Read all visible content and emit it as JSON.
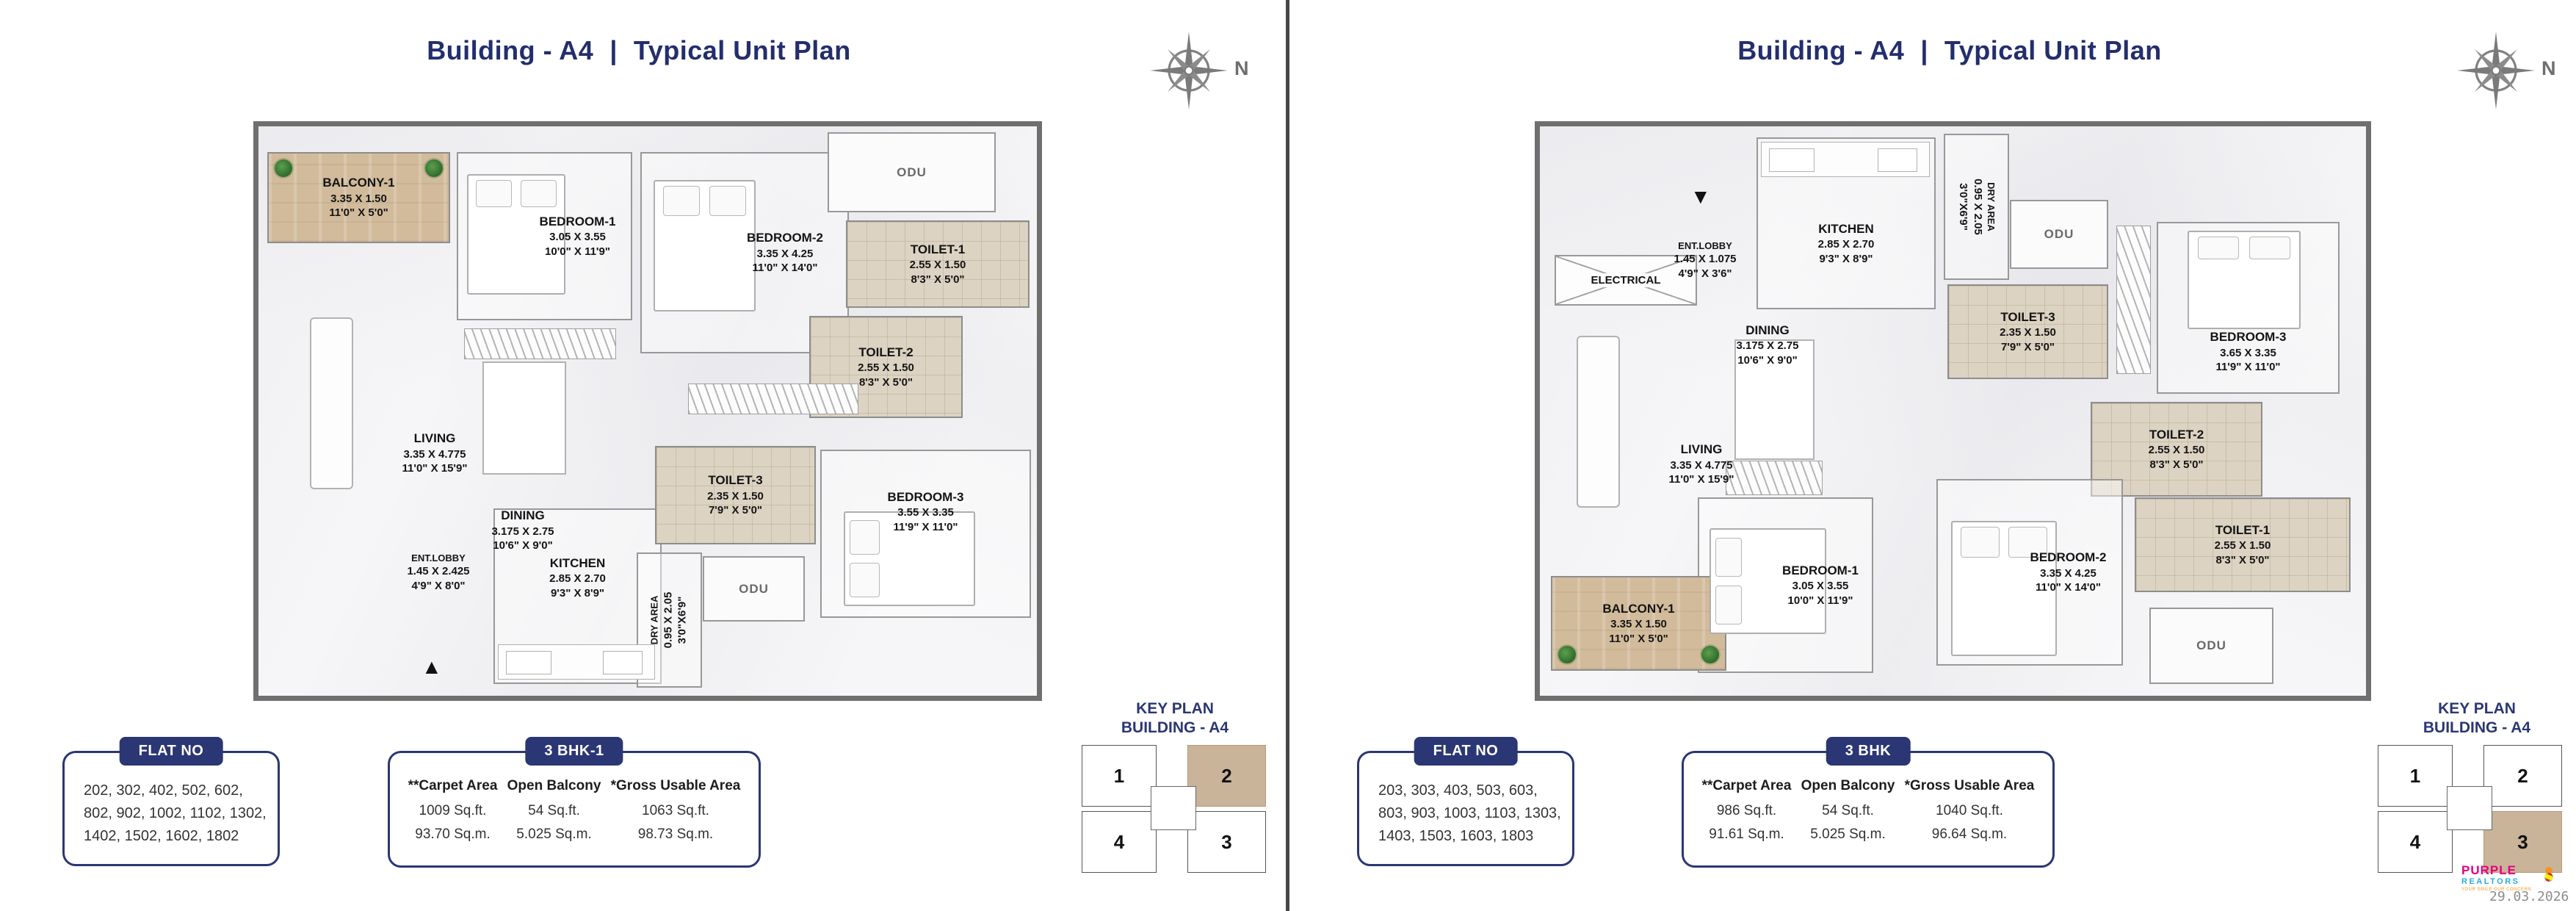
{
  "header_left": {
    "building": "Building - A4",
    "separator": "|",
    "plan": "Typical Unit Plan"
  },
  "header_right": {
    "building": "Building - A4",
    "separator": "|",
    "plan": "Typical Unit Plan"
  },
  "compass": {
    "label": "N"
  },
  "left_plan": {
    "odu": "ODU",
    "entrance_arrow": "▲",
    "rooms": [
      {
        "name": "BALCONY-1",
        "dim_m": "3.35 X 1.50",
        "dim_ft": "11'0\" X 5'0\""
      },
      {
        "name": "BEDROOM-1",
        "dim_m": "3.05 X 3.55",
        "dim_ft": "10'0\" X 11'9\""
      },
      {
        "name": "BEDROOM-2",
        "dim_m": "3.35 X 4.25",
        "dim_ft": "11'0\" X 14'0\""
      },
      {
        "name": "TOILET-1",
        "dim_m": "2.55 X 1.50",
        "dim_ft": "8'3\" X 5'0\""
      },
      {
        "name": "TOILET-2",
        "dim_m": "2.55 X 1.50",
        "dim_ft": "8'3\" X 5'0\""
      },
      {
        "name": "LIVING",
        "dim_m": "3.35 X 4.775",
        "dim_ft": "11'0\" X 15'9\""
      },
      {
        "name": "DINING",
        "dim_m": "3.175 X 2.75",
        "dim_ft": "10'6\" X 9'0\""
      },
      {
        "name": "ENT.LOBBY",
        "dim_m": "1.45 X 2.425",
        "dim_ft": "4'9\" X 8'0\""
      },
      {
        "name": "KITCHEN",
        "dim_m": "2.85 X 2.70",
        "dim_ft": "9'3\" X 8'9\""
      },
      {
        "name": "TOILET-3",
        "dim_m": "2.35 X 1.50",
        "dim_ft": "7'9\" X 5'0\""
      },
      {
        "name": "BEDROOM-3",
        "dim_m": "3.55 X 3.35",
        "dim_ft": "11'9\" X 11'0\""
      },
      {
        "name": "DRY AREA",
        "dim_m": "0.95 X 2.05",
        "dim_ft": "3'0\"X6'9\""
      }
    ],
    "flat_no": {
      "label": "FLAT NO",
      "numbers": "202,  302,  402,  502,  602,\n802,  902,  1002,  1102,  1302,\n1402, 1502, 1602, 1802"
    },
    "bhk": {
      "label": "3 BHK-1",
      "columns": [
        {
          "header": "**Carpet Area",
          "sqft": "1009 Sq.ft.",
          "sqm": "93.70 Sq.m."
        },
        {
          "header": "Open Balcony",
          "sqft": "54 Sq.ft.",
          "sqm": "5.025 Sq.m."
        },
        {
          "header": "*Gross Usable Area",
          "sqft": "1063 Sq.ft.",
          "sqm": "98.73 Sq.m."
        }
      ]
    },
    "key_plan": {
      "line1": "KEY PLAN",
      "line2": "BUILDING - A4",
      "unit1": "1",
      "unit2": "2",
      "unit3": "3",
      "unit4": "4",
      "highlighted": "2"
    }
  },
  "right_plan": {
    "odu": "ODU",
    "entrance_arrow": "▼",
    "rooms": [
      {
        "name": "BALCONY-1",
        "dim_m": "3.35 X 1.50",
        "dim_ft": "11'0\" X 5'0\""
      },
      {
        "name": "BEDROOM-1",
        "dim_m": "3.05 X 3.55",
        "dim_ft": "10'0\" X 11'9\""
      },
      {
        "name": "BEDROOM-2",
        "dim_m": "3.35 X 4.25",
        "dim_ft": "11'0\" X 14'0\""
      },
      {
        "name": "TOILET-1",
        "dim_m": "2.55 X 1.50",
        "dim_ft": "8'3\" X 5'0\""
      },
      {
        "name": "TOILET-2",
        "dim_m": "2.55 X 1.50",
        "dim_ft": "8'3\" X 5'0\""
      },
      {
        "name": "LIVING",
        "dim_m": "3.35 X 4.775",
        "dim_ft": "11'0\" X 15'9\""
      },
      {
        "name": "DINING",
        "dim_m": "3.175 X 2.75",
        "dim_ft": "10'6\" X 9'0\""
      },
      {
        "name": "ENT.LOBBY",
        "dim_m": "1.45 X 1.075",
        "dim_ft": "4'9\" X 3'6\""
      },
      {
        "name": "KITCHEN",
        "dim_m": "2.85 X 2.70",
        "dim_ft": "9'3\" X 8'9\""
      },
      {
        "name": "TOILET-3",
        "dim_m": "2.35 X 1.50",
        "dim_ft": "7'9\" X 5'0\""
      },
      {
        "name": "BEDROOM-3",
        "dim_m": "3.65 X 3.35",
        "dim_ft": "11'9\" X 11'0\""
      },
      {
        "name": "DRY AREA",
        "dim_m": "0.95 X 2.05",
        "dim_ft": "3'0\"X6'9\""
      },
      {
        "name": "ELECTRICAL",
        "dim_m": "",
        "dim_ft": ""
      }
    ],
    "flat_no": {
      "label": "FLAT NO",
      "numbers": "203,  303,  403,  503,  603,\n803,  903,  1003,  1103,  1303,\n1403, 1503, 1603, 1803"
    },
    "bhk": {
      "label": "3 BHK",
      "columns": [
        {
          "header": "**Carpet Area",
          "sqft": "986 Sq.ft.",
          "sqm": "91.61 Sq.m."
        },
        {
          "header": "Open Balcony",
          "sqft": "54 Sq.ft.",
          "sqm": "5.025 Sq.m."
        },
        {
          "header": "*Gross Usable Area",
          "sqft": "1040 Sq.ft.",
          "sqm": "96.64 Sq.m."
        }
      ]
    },
    "key_plan": {
      "line1": "KEY PLAN",
      "line2": "BUILDING - A4",
      "unit1": "1",
      "unit2": "2",
      "unit3": "3",
      "unit4": "4",
      "highlighted": "3"
    }
  },
  "footer": {
    "brand_top": "PURPLE",
    "brand_bottom": "REALTORS",
    "tagline": "YOUR SMILE OUR CONCERN",
    "date": "29.03.2026"
  }
}
